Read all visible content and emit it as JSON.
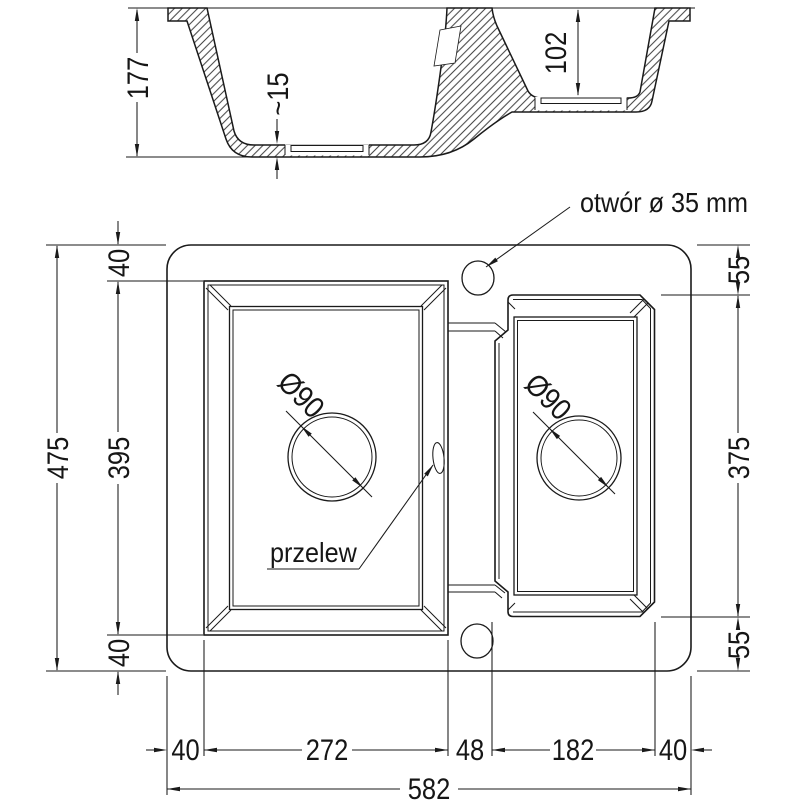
{
  "section": {
    "depth_main": "177",
    "recess_depth": "~15",
    "depth_small": "102"
  },
  "plan": {
    "faucet_hole_label": "otwór ø 35 mm",
    "overflow_label": "przelew",
    "drain_left_label": "Ø90",
    "drain_right_label": "Ø90",
    "dim_total_height": "475",
    "dim_top_margin": "40",
    "dim_left_bowl_height": "395",
    "dim_bottom_margin": "40",
    "dim_right_top": "55",
    "dim_right_bowl_height": "375",
    "dim_right_bottom": "55",
    "dim_left_margin": "40",
    "dim_left_bowl_width": "272",
    "dim_divider": "48",
    "dim_right_bowl_width": "182",
    "dim_right_margin": "40",
    "dim_total_width": "582"
  },
  "colors": {
    "line": "#1a1a1a",
    "background": "#ffffff"
  }
}
